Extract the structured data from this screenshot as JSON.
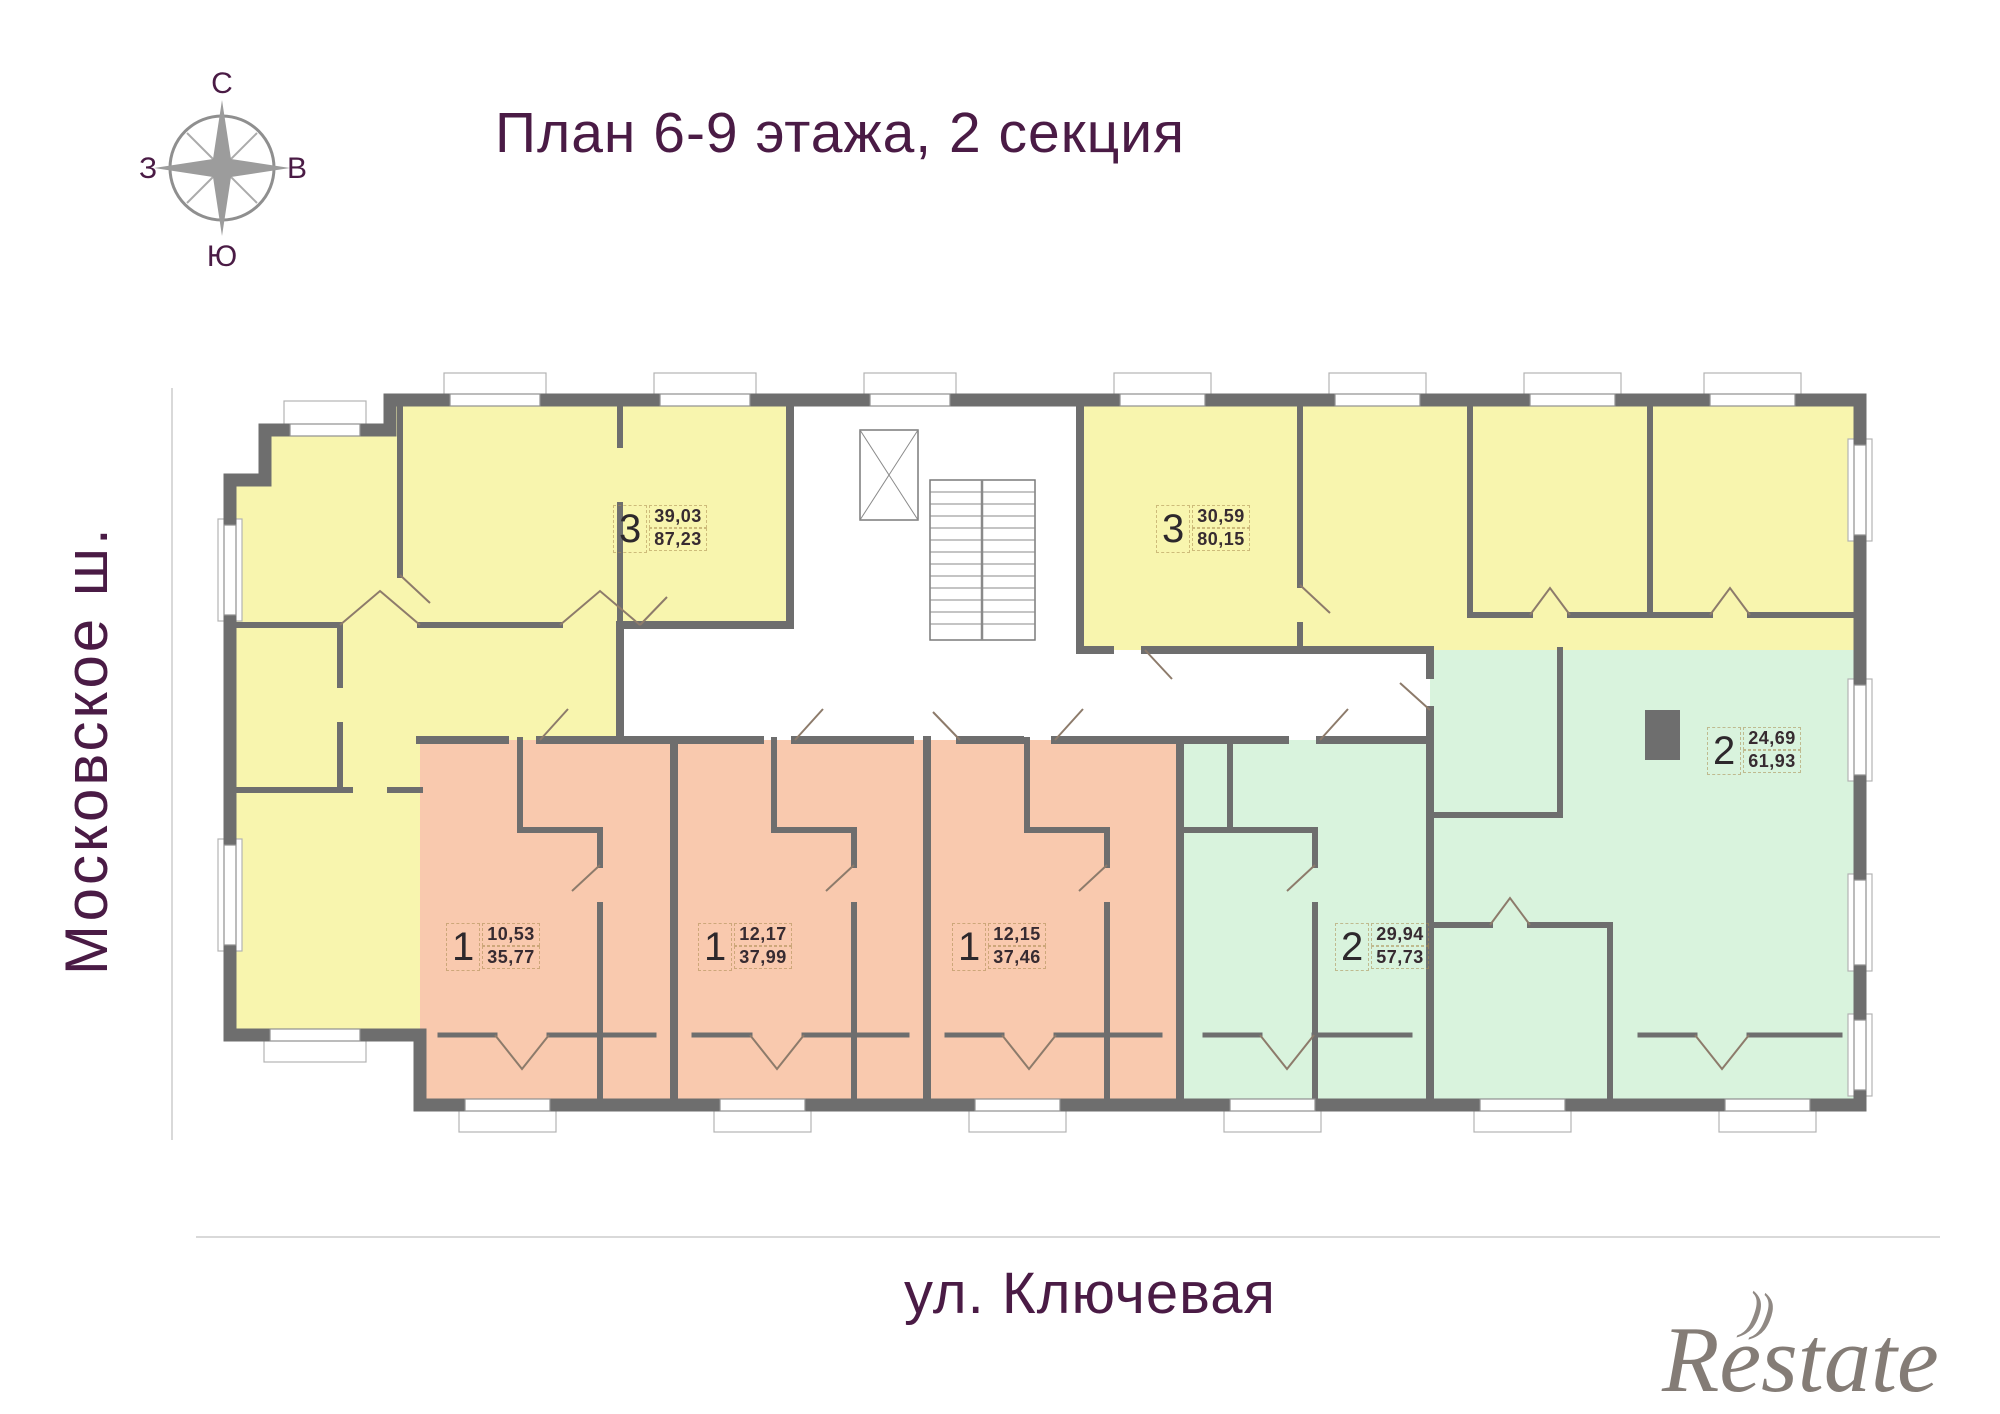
{
  "title": "План 6-9 этажа, 2 секция",
  "compass": {
    "north": "С",
    "east": "В",
    "west": "З",
    "south": "Ю"
  },
  "streets": {
    "left": "Московское ш.",
    "bottom": "ул. Ключевая"
  },
  "watermark": {
    "text": "Restate",
    "swoosh": "))"
  },
  "apartments": [
    {
      "rooms": "3",
      "living_area": "39,03",
      "total_area": "87,23",
      "color_zone": "yellow"
    },
    {
      "rooms": "3",
      "living_area": "30,59",
      "total_area": "80,15",
      "color_zone": "yellow"
    },
    {
      "rooms": "1",
      "living_area": "10,53",
      "total_area": "35,77",
      "color_zone": "salmon"
    },
    {
      "rooms": "1",
      "living_area": "12,17",
      "total_area": "37,99",
      "color_zone": "salmon"
    },
    {
      "rooms": "1",
      "living_area": "12,15",
      "total_area": "37,46",
      "color_zone": "salmon"
    },
    {
      "rooms": "2",
      "living_area": "29,94",
      "total_area": "57,73",
      "color_zone": "mint"
    },
    {
      "rooms": "2",
      "living_area": "24,69",
      "total_area": "61,93",
      "color_zone": "mint"
    }
  ],
  "colors": {
    "accent_purple": "#4a1b45",
    "wall_gray": "#6e6e6e",
    "apartment_yellow": "#f8f5ae",
    "apartment_salmon": "#f9c9ae",
    "apartment_mint": "#d9f3dd",
    "door_line": "#8d7b6b",
    "watermark_gray": "#6a6059"
  }
}
